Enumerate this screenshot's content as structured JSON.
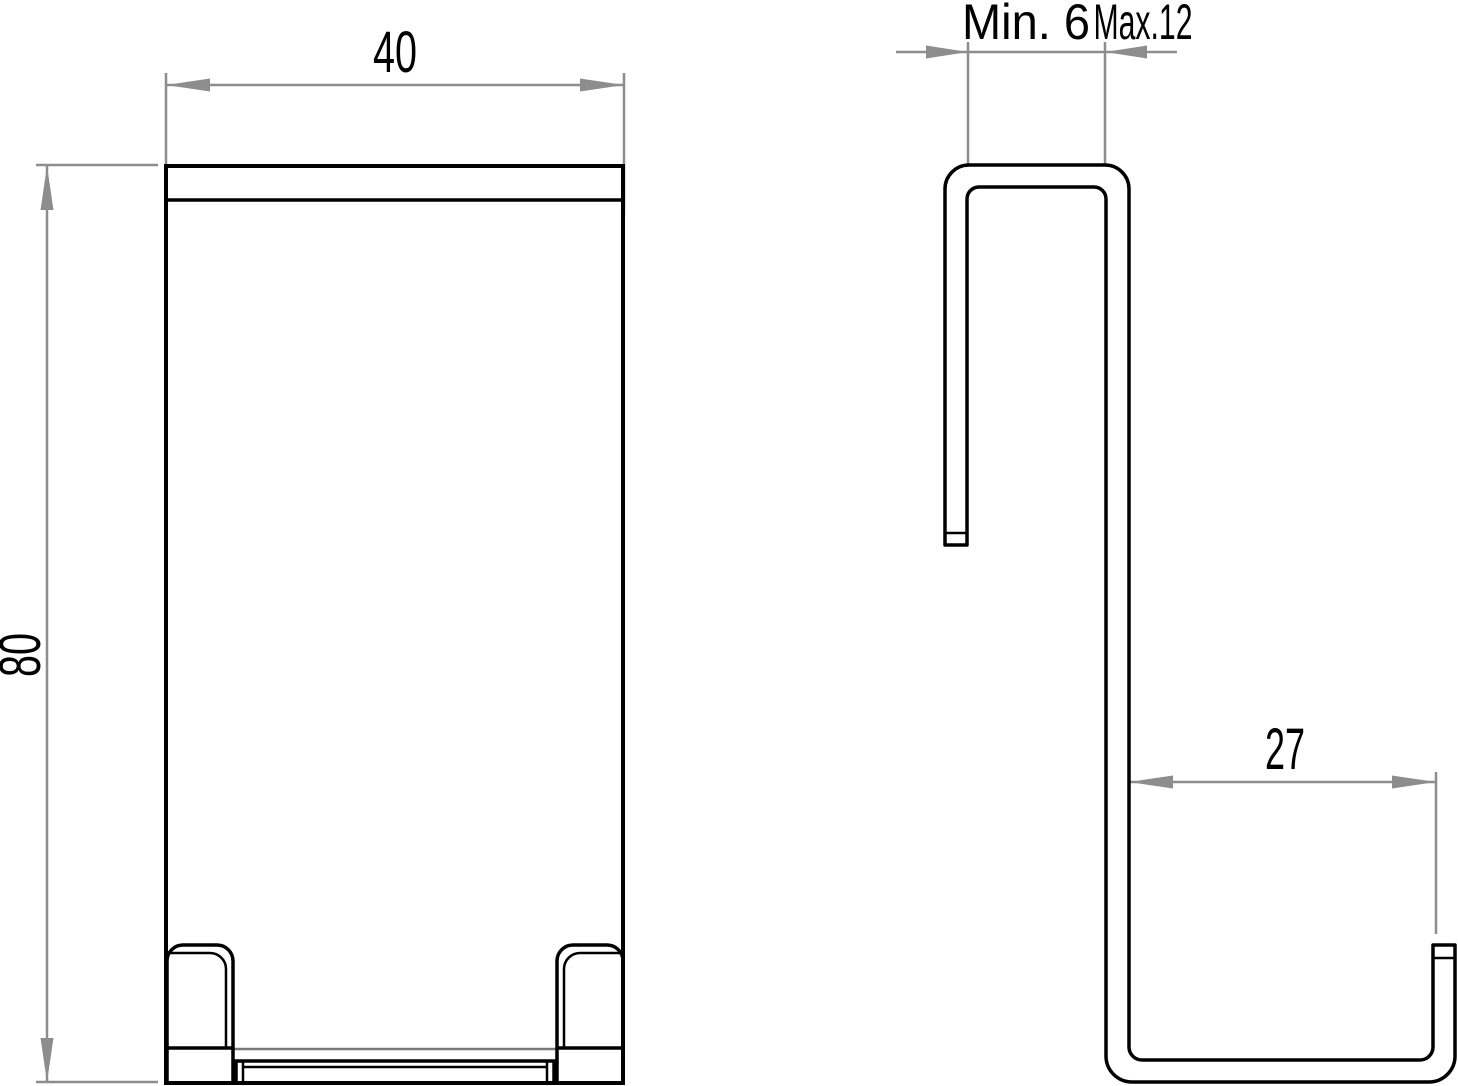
{
  "drawing": {
    "colors": {
      "background": "#ffffff",
      "part_line": "#000000",
      "dimension_line": "#8d8d8d",
      "hidden_line": "#7a7a7a"
    },
    "dimensions": {
      "front_width": "40",
      "front_height": "80",
      "door_thickness_min": "Min. 6",
      "door_thickness_max": "Max.12",
      "hook_depth": "27"
    }
  }
}
